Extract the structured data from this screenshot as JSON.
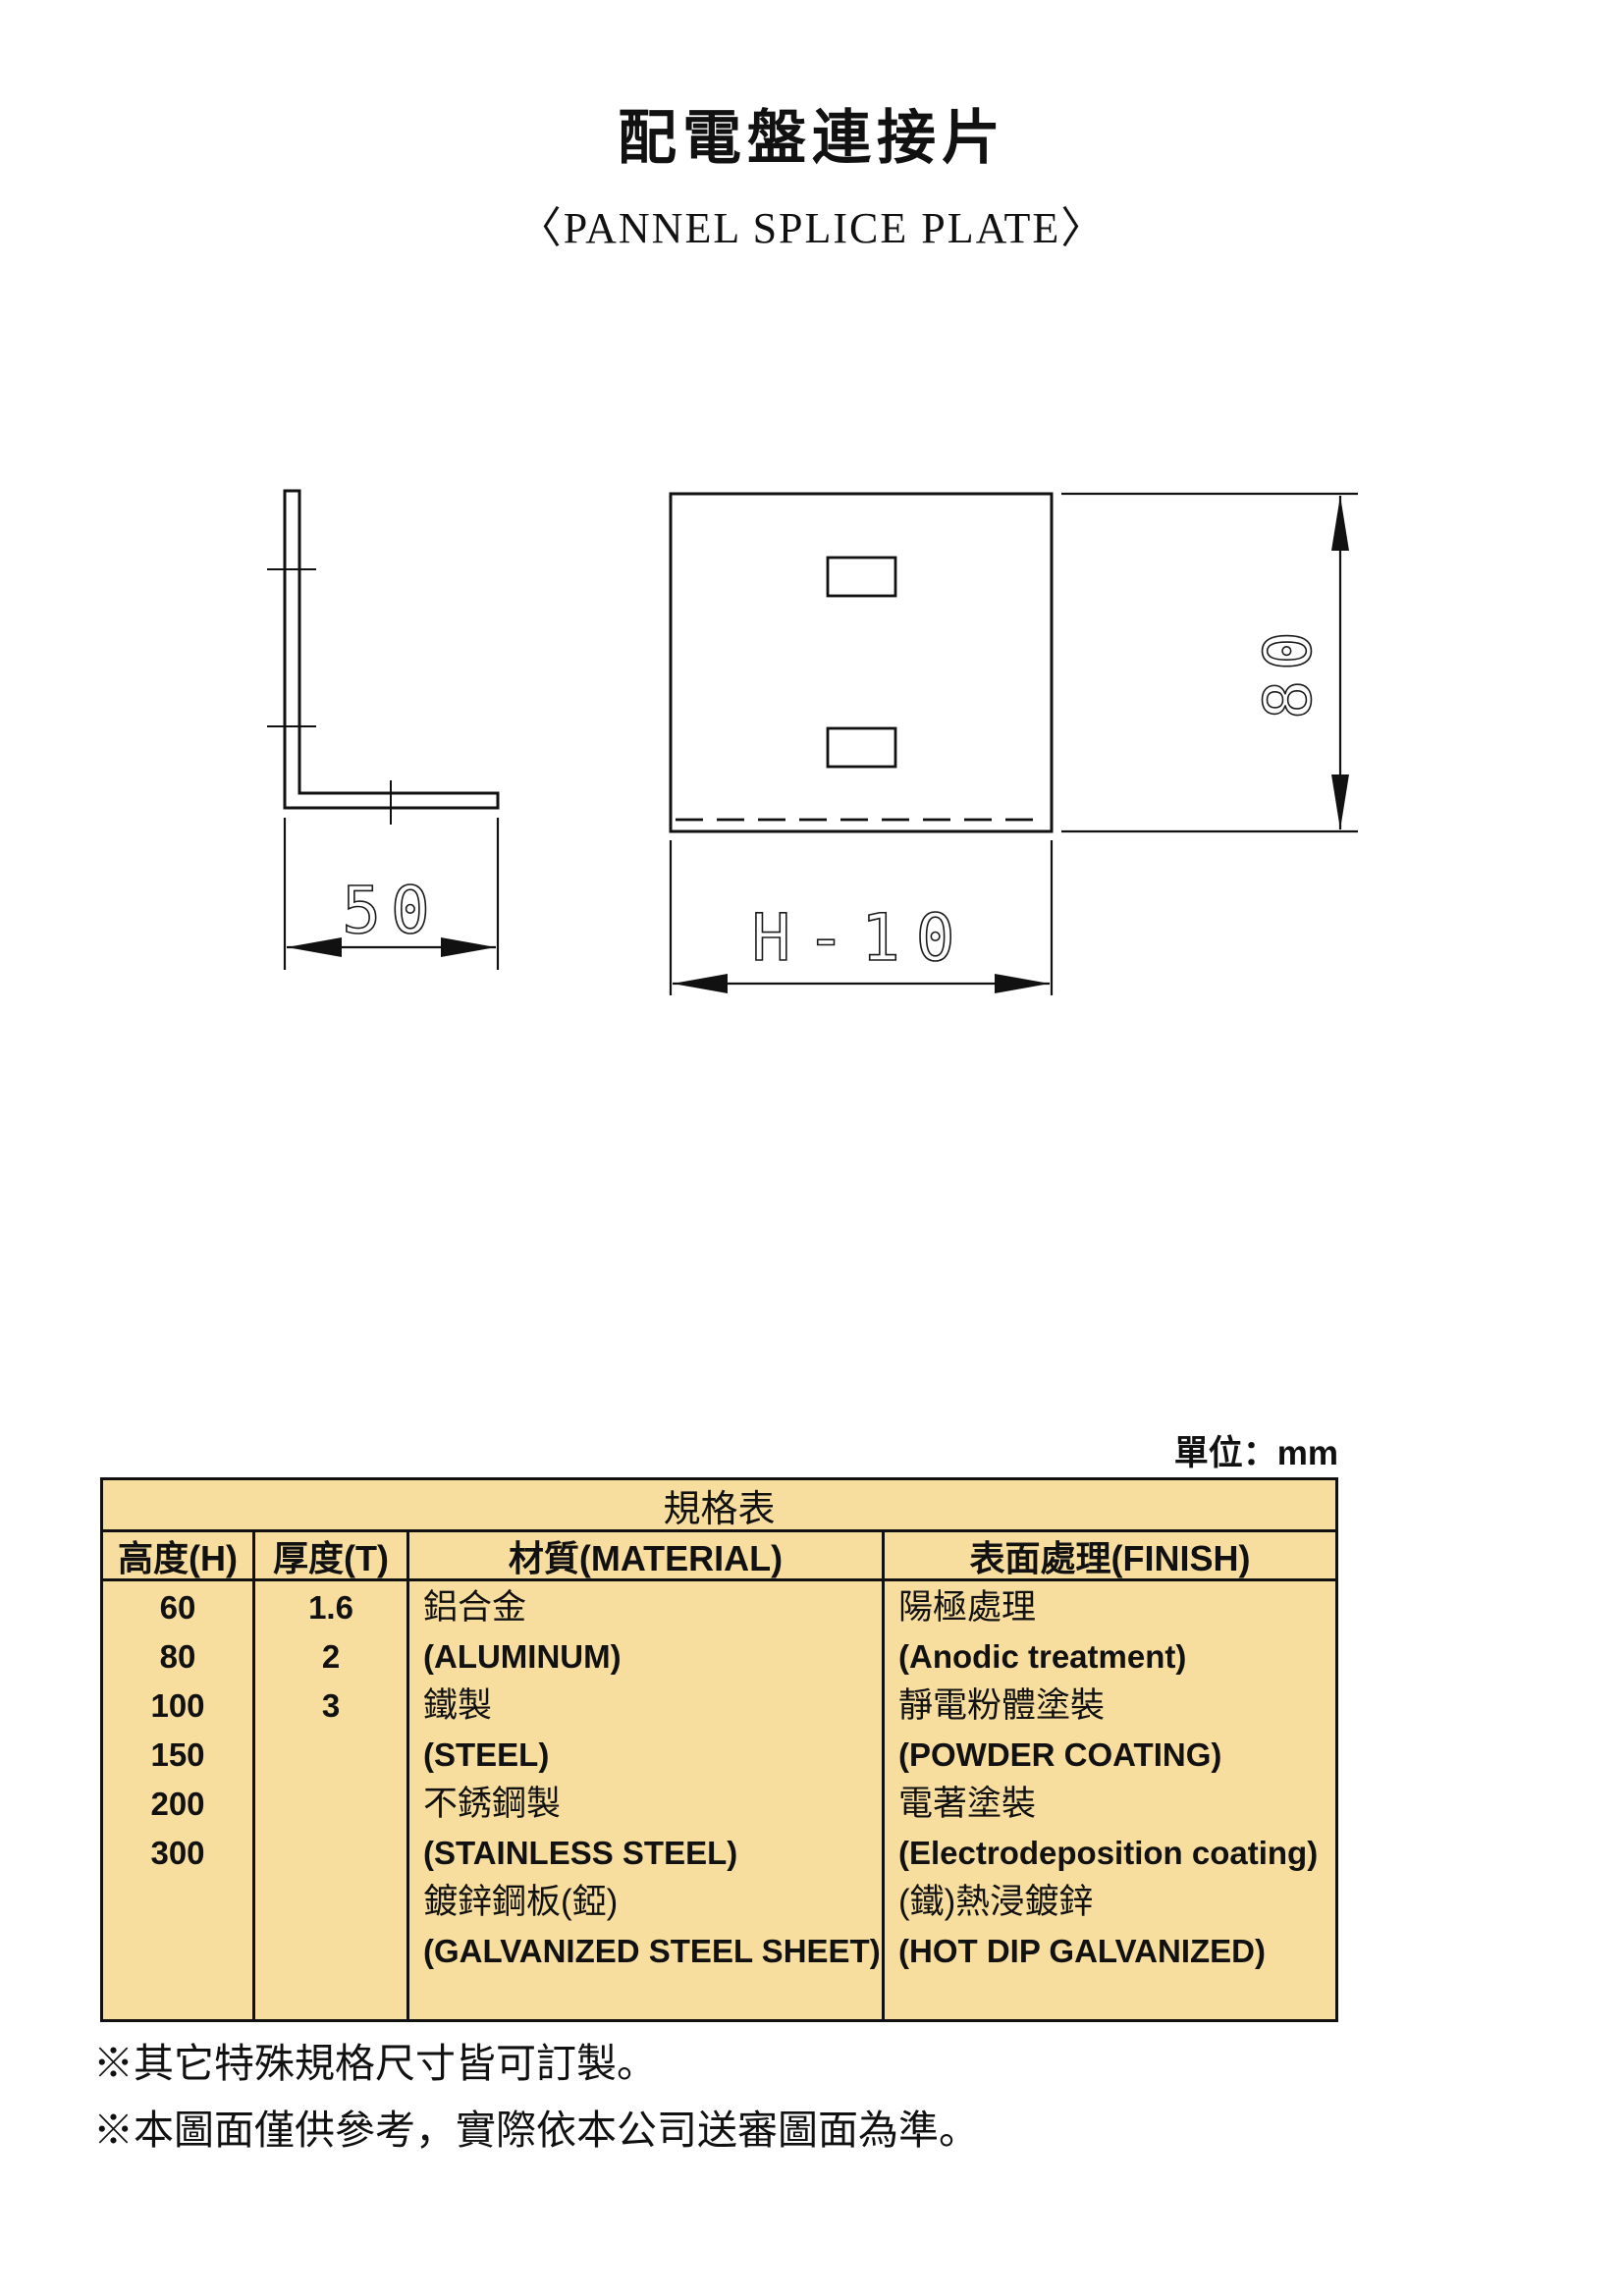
{
  "page": {
    "title": "配電盤連接片",
    "subtitle": "〈PANNEL SPLICE PLATE〉",
    "unit_label": "單位：mm"
  },
  "drawing": {
    "side_view": {
      "width_dim": "50"
    },
    "front_view": {
      "height_dim": "80",
      "width_dim": "H-10"
    }
  },
  "table": {
    "title": "規格表",
    "headers": [
      "高度(H)",
      "厚度(T)",
      "材質(MATERIAL)",
      "表面處理(FINISH)"
    ],
    "heights": [
      "60",
      "80",
      "100",
      "150",
      "200",
      "300"
    ],
    "thicknesses": [
      "1.6",
      "2",
      "3"
    ],
    "materials": [
      "鋁合金",
      "(ALUMINUM)",
      "鐵製",
      "(STEEL)",
      "不銹鋼製",
      "(STAINLESS STEEL)",
      "鍍鋅鋼板(錏)",
      "(GALVANIZED STEEL SHEET)"
    ],
    "finishes": [
      "陽極處理",
      "(Anodic treatment)",
      "靜電粉體塗裝",
      "(POWDER COATING)",
      "電著塗裝",
      "(Electrodeposition coating)",
      "(鐵)熱浸鍍鋅",
      "(HOT DIP GALVANIZED)"
    ],
    "bg_color": "#F8DE9E"
  },
  "notes": [
    "※其它特殊規格尺寸皆可訂製。",
    "※本圖面僅供參考，實際依本公司送審圖面為準。"
  ]
}
